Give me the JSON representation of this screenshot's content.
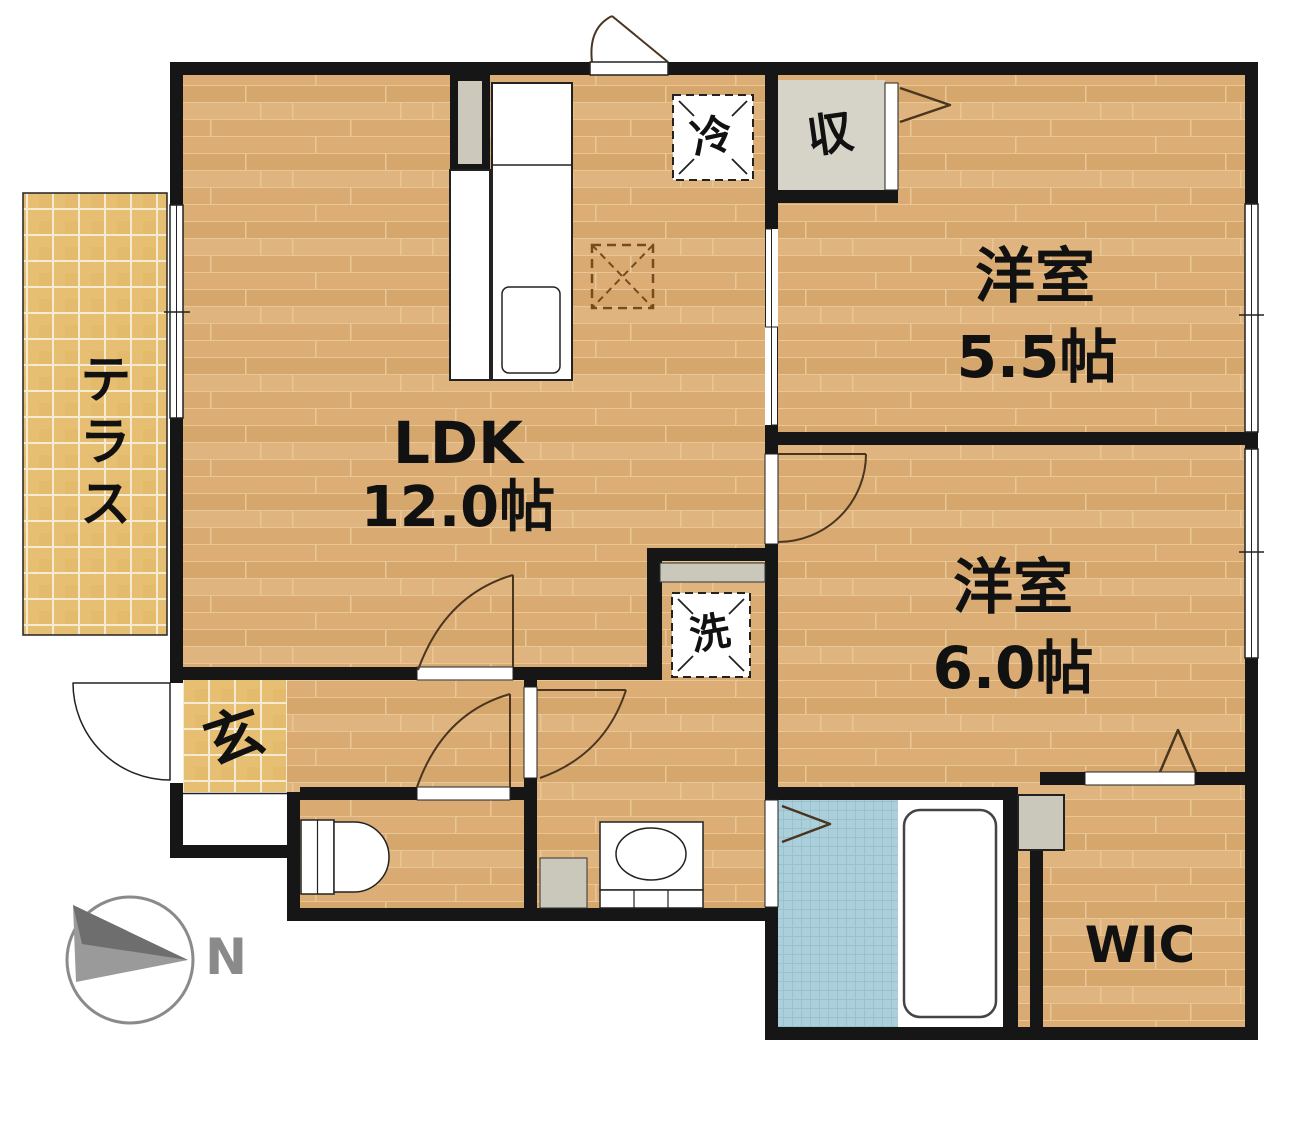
{
  "title": "2LDK apartment floor plan",
  "labels": {
    "terrace": "テラス",
    "ldk_name": "LDK",
    "ldk_size": "12.0帖",
    "room55_name": "洋室",
    "room55_size": "5.5帖",
    "room60_name": "洋室",
    "room60_size": "6.0帖",
    "wic": "WIC",
    "entrance": "玄",
    "refrigerator": "冷",
    "closet": "収",
    "laundry": "洗",
    "compass_north": "N"
  },
  "colors": {
    "wall": "#161616",
    "wood_floor": "#dcae79",
    "tile_floor": "#e6bf72",
    "bath_floor": "#abd0dc",
    "closet_gray": "#d6d3c8",
    "fixture_gray": "#c9c8bb",
    "compass_gray": "#8a8a8a",
    "door_arc": "#4a3520",
    "stove_mark_brown": "#7a4a1e"
  }
}
